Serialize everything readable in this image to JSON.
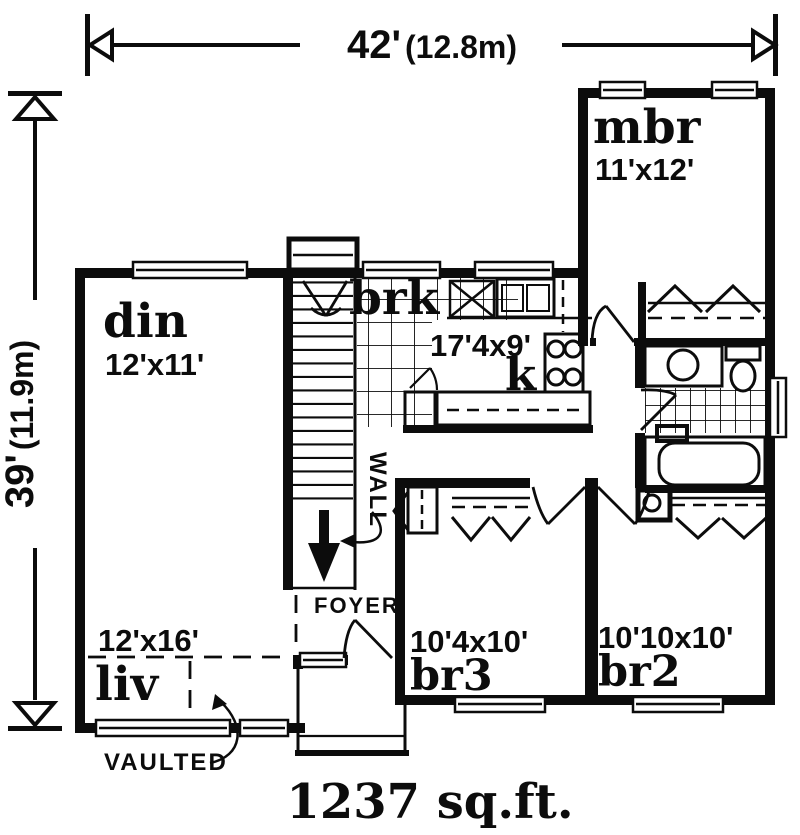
{
  "figure": {
    "type": "floor-plan",
    "area_label": "1237 sq.ft.",
    "dimensions": {
      "width_ft": "42'",
      "width_m": "(12.8m)",
      "height_ft": "39'",
      "height_m": "(11.9m)"
    },
    "rooms": [
      {
        "id": "mbr",
        "label": "mbr",
        "size": "11'x12'"
      },
      {
        "id": "din",
        "label": "din",
        "size": "12'x11'"
      },
      {
        "id": "brk",
        "label": "brk",
        "size": "17'4x9'"
      },
      {
        "id": "kitchen",
        "label": "k",
        "size": ""
      },
      {
        "id": "liv",
        "label": "liv",
        "size": "12'x16'"
      },
      {
        "id": "br3",
        "label": "br3",
        "size": "10'4x10'"
      },
      {
        "id": "br2",
        "label": "br2",
        "size": "10'10x10'"
      }
    ],
    "annotations": {
      "wall": "WALL",
      "foyer": "FOYER",
      "vaulted": "VAULTED"
    }
  }
}
